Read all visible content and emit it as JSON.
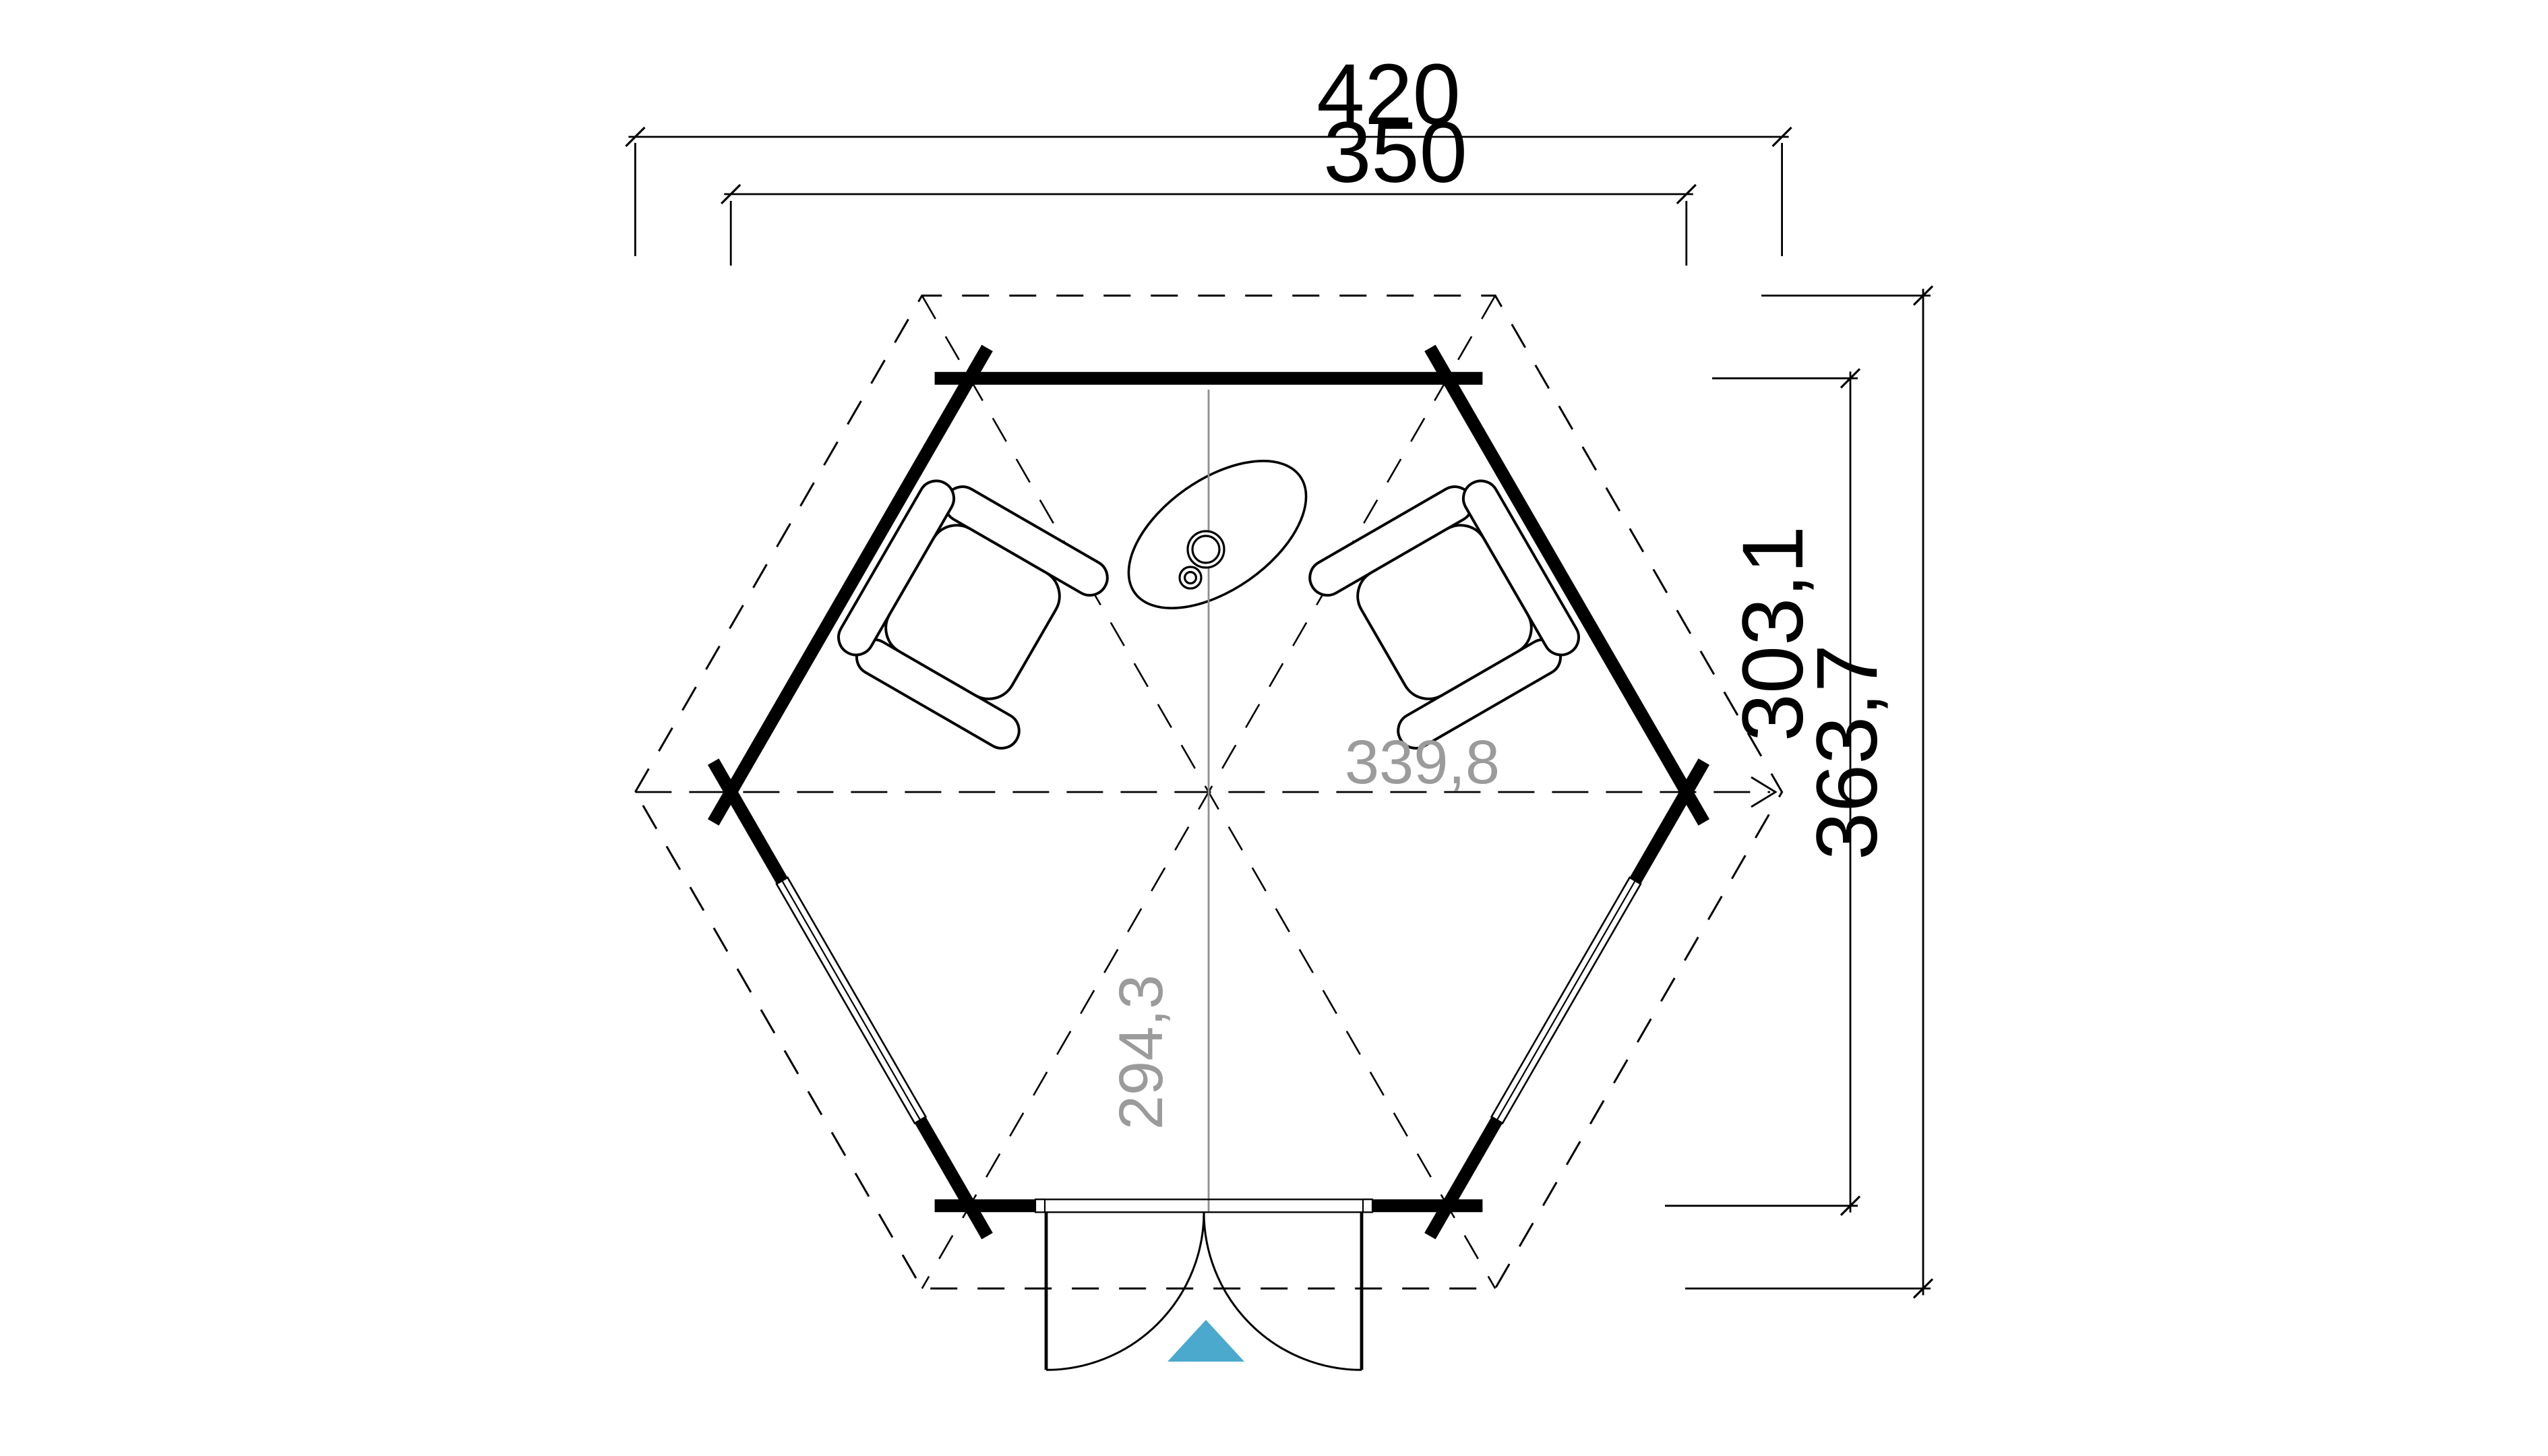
{
  "drawing": {
    "type": "hexagonal-pavilion-floor-plan",
    "unit": "cm",
    "dimensions": {
      "roof_width": "420",
      "wall_width": "350",
      "wall_height": "303,1",
      "roof_height": "363,7",
      "inner_width": "339,8",
      "inner_height": "294,3"
    },
    "colors": {
      "line": "#000000",
      "dim_text_gray": "#9b9b9b",
      "centerline_gray": "#8f8f8f",
      "entrance_arrow_blue": "#4BA9CE",
      "background": "#ffffff"
    },
    "icons": {
      "entrance_arrow": "triangle-up-icon"
    }
  }
}
